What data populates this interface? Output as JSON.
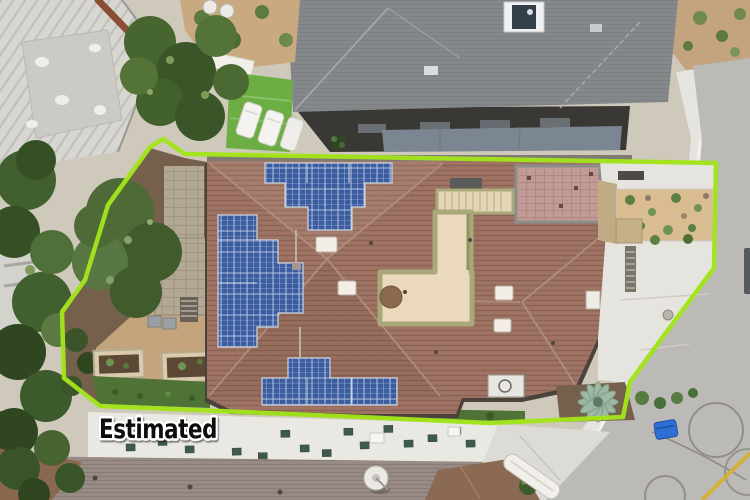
{
  "annotation": {
    "label": "Estimated",
    "boundary_color": "#a2e31b",
    "boundary_points": "163,139 185,154 716,163 714,268 668,330 630,382 623,417 490,423 360,417 100,406 64,378 62,312 85,280 108,205 150,147"
  },
  "scene": {
    "type": "aerial-drone-photo",
    "description": "Overhead drone view of a residential lot: a large home with terracotta tile roof and four rooftop solar arrays outlined by a bright green estimated property boundary; gray-roof neighbor homes above, flat white roof with skylights below, curved street with sidewalk, tire marks and a blue trash bin on the right.",
    "colors": {
      "boundary_green": "#a2e31b",
      "tile_roof": "#9b7060",
      "solar_panel_blue": "#3b5da0",
      "neighbor_roof_gray": "#85888b",
      "turf_green": "#6cae44",
      "concrete": "#e6e4de",
      "street_gray": "#bcbab6",
      "trash_bin_blue": "#2e6fd6",
      "curb_yellow": "#d4b23a",
      "courtyard_cream": "#ead9bc",
      "deck_pink": "#c19b93"
    },
    "features": [
      "terracotta tile hip roof",
      "four rooftop solar panel arrays",
      "rooftop paver deck with stairs",
      "central cream courtyard walkway",
      "artificial turf with lounge chairs",
      "paver patio and raised garden beds",
      "desert landscaping bed",
      "concrete driveway and sidewalk",
      "street with tire marks and blue trash bin",
      "flat white roof with green skylights",
      "satellite dish",
      "agave plant"
    ]
  }
}
